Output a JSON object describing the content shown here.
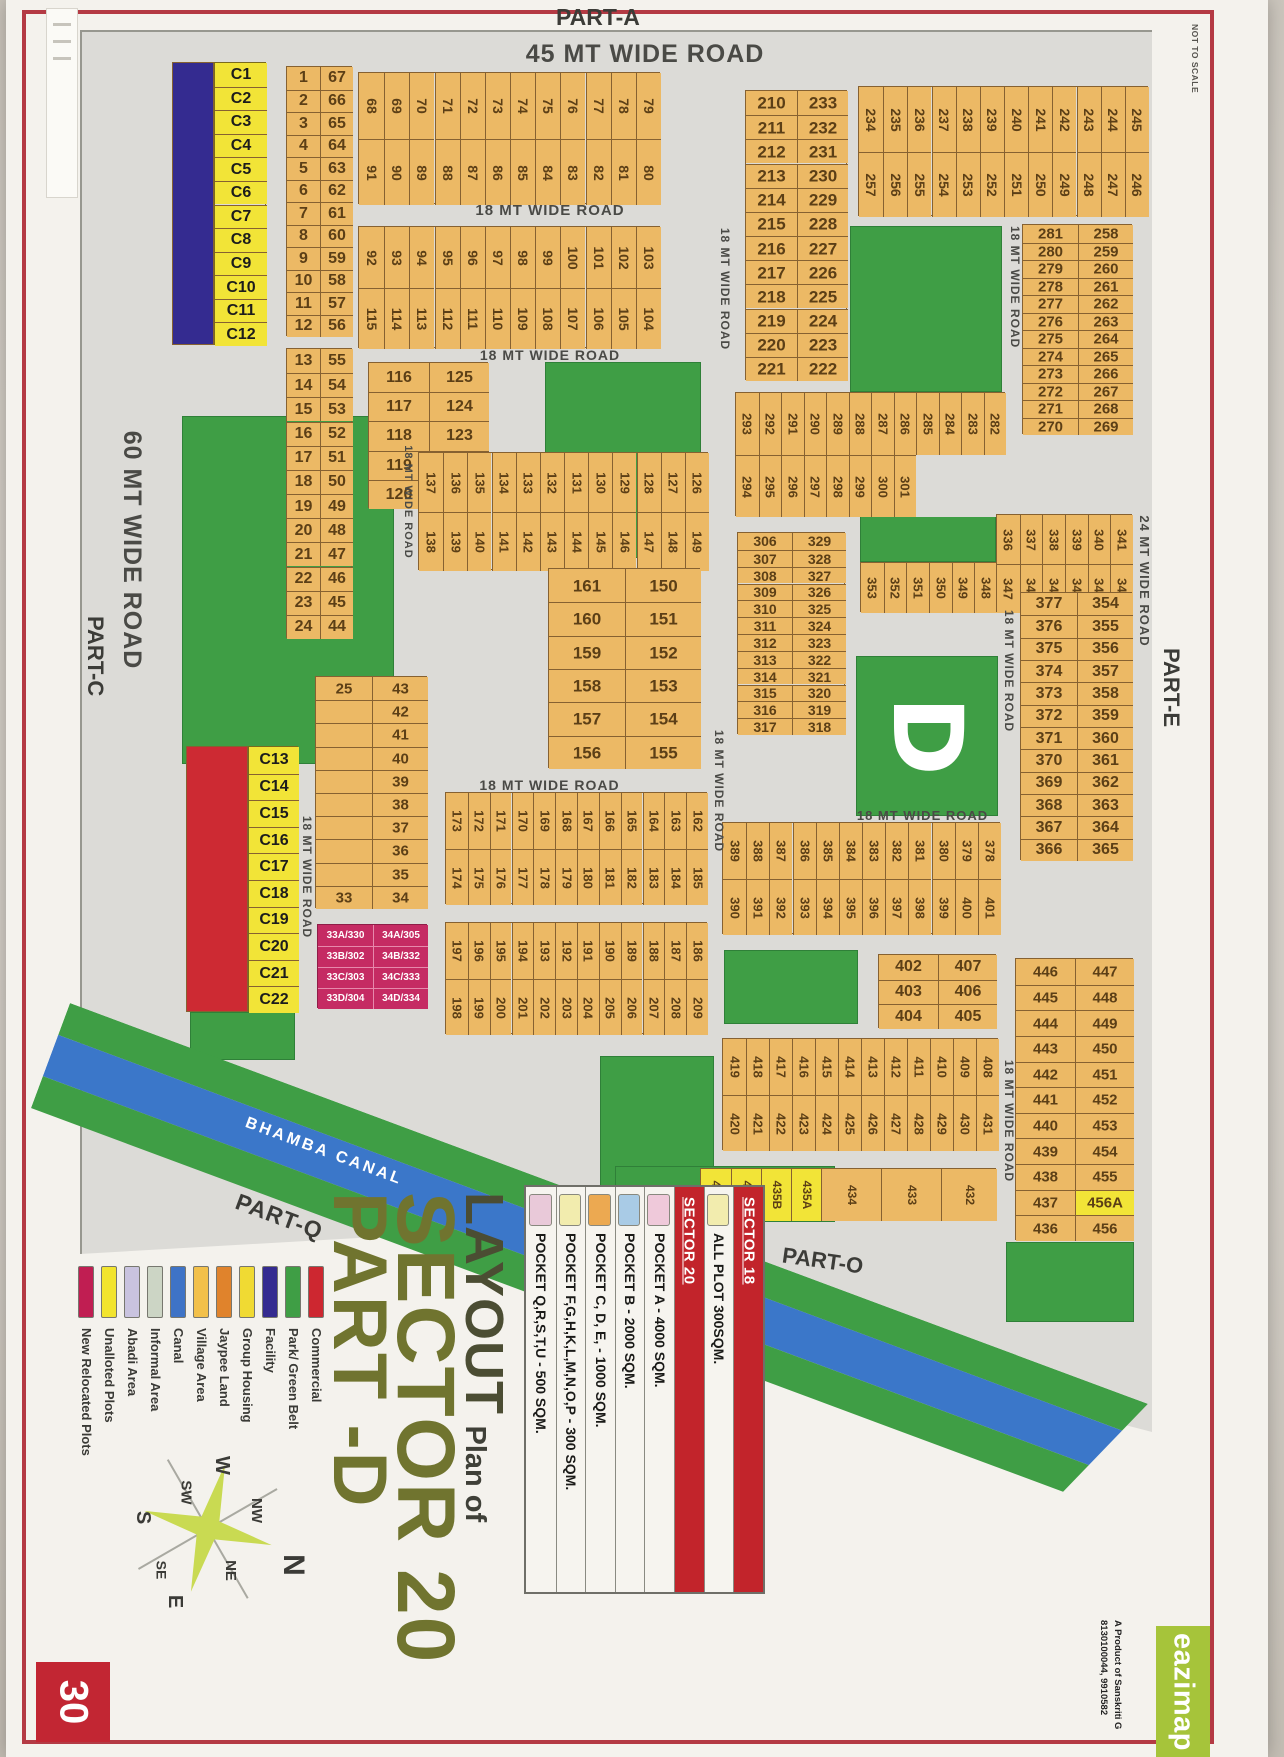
{
  "page": {
    "number": "30",
    "scale_note": "NOT TO SCALE"
  },
  "title": {
    "prefix": "LAYOUT",
    "mid": "Plan of",
    "sector": "SECTOR 20",
    "part": "PART -D"
  },
  "parts": [
    {
      "id": "part-a",
      "text": "PART-A"
    },
    {
      "id": "part-c",
      "text": "PART-C"
    },
    {
      "id": "part-e",
      "text": "PART-E"
    },
    {
      "id": "part-o",
      "text": "PART-O"
    },
    {
      "id": "part-q",
      "text": "PART-Q"
    }
  ],
  "canal": {
    "label": "BHAMBA CANAL"
  },
  "district_letter": "D",
  "brand": {
    "name": "eazimap",
    "sub1": "A Product of Sanskriti G",
    "sub2": "8130100044, 9910582"
  },
  "compass": {
    "labels": [
      "N",
      "NE",
      "E",
      "SE",
      "S",
      "SW",
      "W",
      "NW"
    ]
  },
  "colors": {
    "plot": "#ecb965",
    "plot_border": "#866131",
    "plot_text": "#5c3f16",
    "green": "#3f9e45",
    "canal_blue": "#3b77c9",
    "facility": "#342b90",
    "unallotted": "#f2e437",
    "commercial": "#cd2a33",
    "relocated": "#c52b63",
    "map_bg": "#dcdbd7",
    "road_text": "#4a4a46"
  },
  "roads": [
    {
      "id": "r45",
      "text": "45 MT WIDE ROAD"
    },
    {
      "id": "r60",
      "text": "60 MT WIDE ROAD"
    },
    {
      "id": "r24",
      "text": "24 MT WIDE ROAD"
    },
    {
      "id": "r18a",
      "text": "18 MT WIDE ROAD"
    },
    {
      "id": "r18b",
      "text": "18 MT WIDE ROAD"
    },
    {
      "id": "r18c",
      "text": "18 MT WIDE ROAD"
    },
    {
      "id": "r18d",
      "text": "18 MT WIDE ROAD"
    },
    {
      "id": "r18e",
      "text": "18 MT WIDE ROAD"
    },
    {
      "id": "r18f",
      "text": "18 MT WIDE ROAD"
    },
    {
      "id": "r18g",
      "text": "18 MT WIDE ROAD"
    },
    {
      "id": "r18h",
      "text": "18 MT WIDE ROAD"
    },
    {
      "id": "r18i",
      "text": "18 MT WIDE ROAD"
    },
    {
      "id": "r18j",
      "text": "18 MT WIDE ROAD"
    },
    {
      "id": "r18k",
      "text": "18 MT WIDE ROAD"
    }
  ],
  "legend": {
    "items": [
      {
        "label": "New Relocated Plots",
        "color": "#c01e52"
      },
      {
        "label": "Unalloted Plots",
        "color": "#f2e42e"
      },
      {
        "label": "Abadi Area",
        "color": "#c9c3df"
      },
      {
        "label": "Informal Area",
        "color": "#ccd5c5"
      },
      {
        "label": "Canal",
        "color": "#3e73c6"
      },
      {
        "label": "Village Area",
        "color": "#f2c04a"
      },
      {
        "label": "Jaypee Land",
        "color": "#e0832c"
      },
      {
        "label": "Group Housing",
        "color": "#f0da33"
      },
      {
        "label": "Facility",
        "color": "#342b90"
      },
      {
        "label": "Park/ Green Belt",
        "color": "#3f9e45"
      },
      {
        "label": "Commercial",
        "color": "#cd2730"
      }
    ]
  },
  "pockets": {
    "rows": [
      {
        "text": "SECTOR 18",
        "header": true
      },
      {
        "text": "ALL PLOT 300SQM.",
        "swatch": "#f2ecae"
      },
      {
        "text": "SECTOR 20",
        "header": true
      },
      {
        "text": "POCKET A   -  4000 SQM.",
        "swatch": "#efc9da"
      },
      {
        "text": "POCKET B   -  2000 SQM.",
        "swatch": "#a9cbe6"
      },
      {
        "text": "POCKET C, D, E, - 1000 SQM.",
        "swatch": "#eca951"
      },
      {
        "text": "POCKET  F,G,H,K,L,M,N,O,P  -  300 SQM.",
        "swatch": "#f2ecae"
      },
      {
        "text": "POCKET Q,R,S,T,U   -  500 SQM.",
        "swatch": "#e9c9d9"
      }
    ]
  },
  "highlight_values": [
    "456A",
    "435A",
    "435B",
    "435C",
    "435D"
  ],
  "blocks": [
    {
      "id": "fac",
      "kind": "rect",
      "fill": "facility"
    },
    {
      "id": "redb",
      "kind": "rect",
      "fill": "commercial"
    },
    {
      "id": "c1",
      "kind": "list",
      "fill": "unallotted",
      "cells": [
        "C1",
        "C2",
        "C3",
        "C4",
        "C5",
        "C6",
        "C7",
        "C8",
        "C9",
        "C10",
        "C11",
        "C12"
      ]
    },
    {
      "id": "c13",
      "kind": "list",
      "fill": "unallotted",
      "cells": [
        "C13",
        "C14",
        "C15",
        "C16",
        "C17",
        "C18",
        "C19",
        "C20",
        "C21",
        "C22"
      ]
    },
    {
      "id": "p1",
      "kind": "pairs",
      "rows": [
        [
          "1",
          "67"
        ],
        [
          "2",
          "66"
        ],
        [
          "3",
          "65"
        ],
        [
          "4",
          "64"
        ],
        [
          "5",
          "63"
        ],
        [
          "6",
          "62"
        ],
        [
          "7",
          "61"
        ],
        [
          "8",
          "60"
        ],
        [
          "9",
          "59"
        ],
        [
          "10",
          "58"
        ],
        [
          "11",
          "57"
        ],
        [
          "12",
          "56"
        ]
      ]
    },
    {
      "id": "p13",
      "kind": "pairs",
      "rows": [
        [
          "13",
          "55"
        ],
        [
          "14",
          "54"
        ],
        [
          "15",
          "53"
        ],
        [
          "16",
          "52"
        ],
        [
          "17",
          "51"
        ],
        [
          "18",
          "50"
        ],
        [
          "19",
          "49"
        ],
        [
          "20",
          "48"
        ],
        [
          "21",
          "47"
        ],
        [
          "22",
          "46"
        ],
        [
          "23",
          "45"
        ],
        [
          "24",
          "44"
        ]
      ]
    },
    {
      "id": "b68",
      "kind": "cols",
      "top": [
        "68",
        "69",
        "70",
        "71",
        "72",
        "73",
        "74",
        "75",
        "76",
        "77",
        "78",
        "79"
      ],
      "bottom": [
        "91",
        "90",
        "89",
        "88",
        "87",
        "86",
        "85",
        "84",
        "83",
        "82",
        "81",
        "80"
      ]
    },
    {
      "id": "b92",
      "kind": "cols",
      "top": [
        "92",
        "93",
        "94",
        "95",
        "96",
        "97",
        "98",
        "99",
        "100",
        "101",
        "102",
        "103"
      ],
      "bottom": [
        "115",
        "114",
        "113",
        "112",
        "111",
        "110",
        "109",
        "108",
        "107",
        "106",
        "105",
        "104"
      ]
    },
    {
      "id": "p116",
      "kind": "pairs",
      "rows": [
        [
          "116",
          "125"
        ],
        [
          "117",
          "124"
        ],
        [
          "118",
          "123"
        ],
        [
          "119",
          "122"
        ],
        [
          "120",
          "121"
        ]
      ]
    },
    {
      "id": "b126",
      "kind": "cols",
      "top": [
        "137",
        "136",
        "135",
        "134",
        "133",
        "132",
        "131",
        "130",
        "129",
        "128",
        "127",
        "126"
      ],
      "bottom": [
        "138",
        "139",
        "140",
        "141",
        "142",
        "143",
        "144",
        "145",
        "146",
        "147",
        "148",
        "149"
      ]
    },
    {
      "id": "p156",
      "kind": "pairs",
      "rows": [
        [
          "161",
          "150"
        ],
        [
          "160",
          "151"
        ],
        [
          "159",
          "152"
        ],
        [
          "158",
          "153"
        ],
        [
          "157",
          "154"
        ],
        [
          "156",
          "155"
        ]
      ]
    },
    {
      "id": "p25",
      "kind": "pairs",
      "rows": [
        [
          "25",
          "43"
        ],
        [
          "",
          "42"
        ],
        [
          "",
          "41"
        ],
        [
          "",
          "40"
        ],
        [
          "",
          "39"
        ],
        [
          "",
          "38"
        ],
        [
          "",
          "37"
        ],
        [
          "",
          "36"
        ],
        [
          "",
          "35"
        ],
        [
          "33",
          "34"
        ]
      ]
    },
    {
      "id": "pink",
      "kind": "grid2",
      "fill": "relocated",
      "rows": [
        [
          "33A/330",
          "34A/305"
        ],
        [
          "33B/302",
          "34B/332"
        ],
        [
          "33C/303",
          "34C/333"
        ],
        [
          "33D/304",
          "34D/334"
        ]
      ]
    },
    {
      "id": "b162",
      "kind": "cols",
      "top": [
        "173",
        "172",
        "171",
        "170",
        "169",
        "168",
        "167",
        "166",
        "165",
        "164",
        "163",
        "162"
      ],
      "bottom": [
        "174",
        "175",
        "176",
        "177",
        "178",
        "179",
        "180",
        "181",
        "182",
        "183",
        "184",
        "185"
      ]
    },
    {
      "id": "b186",
      "kind": "cols",
      "top": [
        "197",
        "196",
        "195",
        "194",
        "193",
        "192",
        "191",
        "190",
        "189",
        "188",
        "187",
        "186"
      ],
      "bottom": [
        "198",
        "199",
        "200",
        "201",
        "202",
        "203",
        "204",
        "205",
        "206",
        "207",
        "208",
        "209"
      ]
    },
    {
      "id": "p210",
      "kind": "pairs",
      "rows": [
        [
          "210",
          "233"
        ],
        [
          "211",
          "232"
        ],
        [
          "212",
          "231"
        ],
        [
          "213",
          "230"
        ],
        [
          "214",
          "229"
        ],
        [
          "215",
          "228"
        ],
        [
          "216",
          "227"
        ],
        [
          "217",
          "226"
        ],
        [
          "218",
          "225"
        ],
        [
          "219",
          "224"
        ],
        [
          "220",
          "223"
        ],
        [
          "221",
          "222"
        ]
      ]
    },
    {
      "id": "b234",
      "kind": "cols",
      "top": [
        "234",
        "235",
        "236",
        "237",
        "238",
        "239",
        "240",
        "241",
        "242",
        "243",
        "244",
        "245"
      ],
      "bottom": [
        "257",
        "256",
        "255",
        "254",
        "253",
        "252",
        "251",
        "250",
        "249",
        "248",
        "247",
        "246"
      ]
    },
    {
      "id": "p258",
      "kind": "pairs",
      "rows": [
        [
          "281",
          "258"
        ],
        [
          "280",
          "259"
        ],
        [
          "279",
          "260"
        ],
        [
          "278",
          "261"
        ],
        [
          "277",
          "262"
        ],
        [
          "276",
          "263"
        ],
        [
          "275",
          "264"
        ],
        [
          "274",
          "265"
        ],
        [
          "273",
          "266"
        ],
        [
          "272",
          "267"
        ],
        [
          "271",
          "268"
        ],
        [
          "270",
          "269"
        ]
      ]
    },
    {
      "id": "b282",
      "kind": "cols",
      "top": [
        "293",
        "292",
        "291",
        "290",
        "289",
        "288",
        "287",
        "286",
        "285",
        "284",
        "283",
        "282"
      ],
      "bottom": [
        "294",
        "295",
        "296",
        "297",
        "298",
        "299",
        "300",
        "301"
      ]
    },
    {
      "id": "p306",
      "kind": "pairs",
      "rows": [
        [
          "306",
          "329"
        ],
        [
          "307",
          "328"
        ],
        [
          "308",
          "327"
        ],
        [
          "309",
          "326"
        ],
        [
          "310",
          "325"
        ],
        [
          "311",
          "324"
        ],
        [
          "312",
          "323"
        ],
        [
          "313",
          "322"
        ],
        [
          "314",
          "321"
        ],
        [
          "315",
          "320"
        ],
        [
          "316",
          "319"
        ],
        [
          "317",
          "318"
        ]
      ]
    },
    {
      "id": "r348",
      "kind": "row",
      "cells": [
        "353",
        "352",
        "351",
        "350",
        "349",
        "348"
      ]
    },
    {
      "id": "r336",
      "kind": "cols",
      "top": [
        "336",
        "337",
        "338",
        "339",
        "340",
        "341"
      ],
      "bottom": [
        "347",
        "346",
        "345",
        "344",
        "343",
        "342"
      ]
    },
    {
      "id": "p354",
      "kind": "pairs",
      "rows": [
        [
          "377",
          "354"
        ],
        [
          "376",
          "355"
        ],
        [
          "375",
          "356"
        ],
        [
          "374",
          "357"
        ],
        [
          "373",
          "358"
        ],
        [
          "372",
          "359"
        ],
        [
          "371",
          "360"
        ],
        [
          "370",
          "361"
        ],
        [
          "369",
          "362"
        ],
        [
          "368",
          "363"
        ],
        [
          "367",
          "364"
        ],
        [
          "366",
          "365"
        ]
      ]
    },
    {
      "id": "b378",
      "kind": "cols",
      "top": [
        "389",
        "388",
        "387",
        "386",
        "385",
        "384",
        "383",
        "382",
        "381",
        "380",
        "379",
        "378"
      ],
      "bottom": [
        "390",
        "391",
        "392",
        "393",
        "394",
        "395",
        "396",
        "397",
        "398",
        "399",
        "400",
        "401"
      ]
    },
    {
      "id": "p402",
      "kind": "pairs",
      "rows": [
        [
          "402",
          "407"
        ],
        [
          "403",
          "406"
        ],
        [
          "404",
          "405"
        ]
      ]
    },
    {
      "id": "b408",
      "kind": "cols",
      "top": [
        "419",
        "418",
        "417",
        "416",
        "415",
        "414",
        "413",
        "412",
        "411",
        "410",
        "409",
        "408"
      ],
      "bottom": [
        "420",
        "421",
        "422",
        "423",
        "424",
        "425",
        "426",
        "427",
        "428",
        "429",
        "430",
        "431"
      ]
    },
    {
      "id": "row432",
      "kind": "row",
      "cells": [
        "435D",
        "435C",
        "435B",
        "435A",
        "434",
        "433",
        "432"
      ]
    },
    {
      "id": "p436",
      "kind": "pairs",
      "rows": [
        [
          "446",
          "447"
        ],
        [
          "445",
          "448"
        ],
        [
          "444",
          "449"
        ],
        [
          "443",
          "450"
        ],
        [
          "442",
          "451"
        ],
        [
          "441",
          "452"
        ],
        [
          "440",
          "453"
        ],
        [
          "439",
          "454"
        ],
        [
          "438",
          "455"
        ],
        [
          "437",
          "456A"
        ],
        [
          "436",
          "456"
        ]
      ]
    }
  ]
}
